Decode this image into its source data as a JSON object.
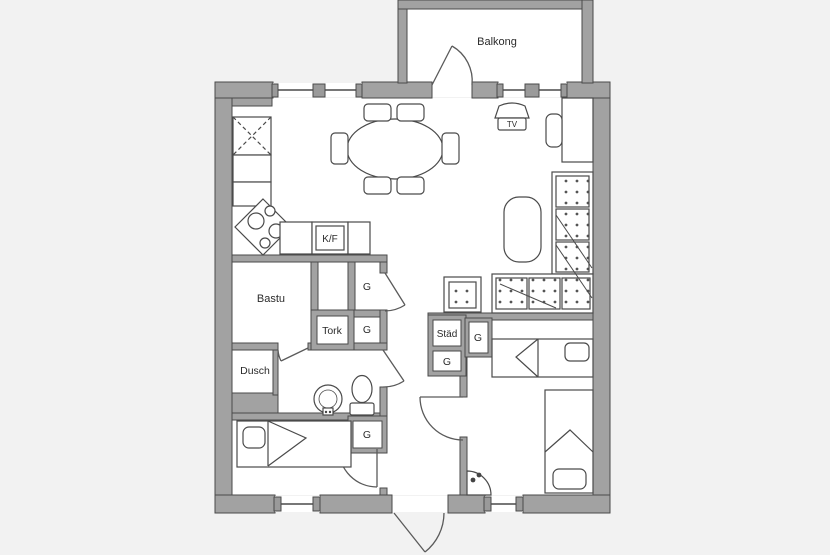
{
  "floorplan": {
    "labels": {
      "balcony": "Balkong",
      "sauna": "Bastu",
      "shower": "Dusch",
      "drying_cabinet": "Tork",
      "cleaning_closet": "Städ",
      "fridge_freezer": "K/F",
      "tv": "TV",
      "wardrobe": "G"
    },
    "colors": {
      "wall_fill": "#a2a2a2",
      "wall_outline": "#4a4a4a",
      "furniture_line": "#4a4a4a",
      "floor": "#ffffff",
      "background": "#f2f2f2",
      "label_text": "#2b2b2b"
    }
  }
}
